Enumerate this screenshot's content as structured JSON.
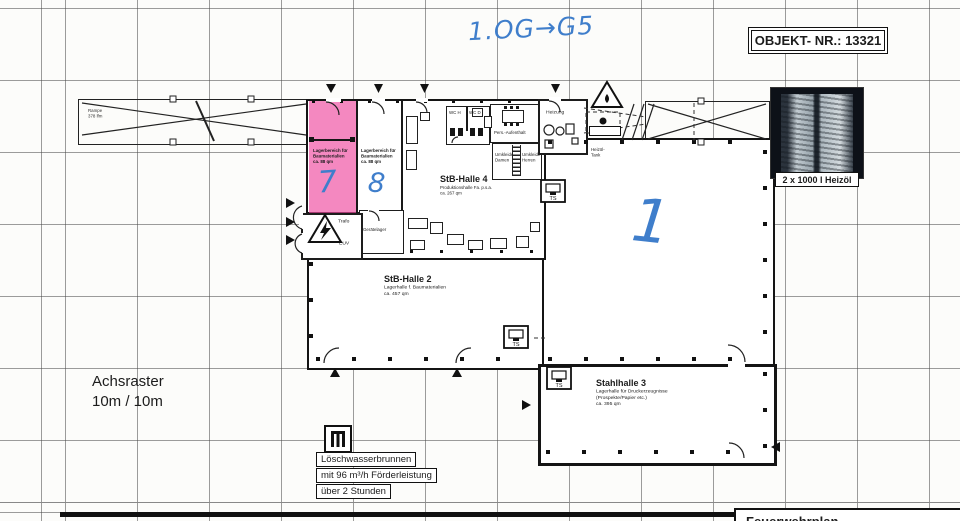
{
  "header": {
    "object_nr": "OBJEKT- NR.: 13321",
    "handwritten_note": "1.OG→G5"
  },
  "photo": {
    "caption": "2 x 1000 l Heizöl"
  },
  "axis": {
    "text": "Achsraster\n10m / 10m"
  },
  "halls": {
    "halle4": {
      "name": "StB-Halle 4",
      "details": "Produktionshalle Fa. p.s.a.\nca. 267 qm"
    },
    "halle2": {
      "name": "StB-Halle 2",
      "details": "Lagerhalle f. Baumaterialien\nca. 457 qm"
    },
    "halle3": {
      "name": "Stahlhalle 3",
      "details": "Lagerhalle für Druckerzeugnisse\n(Prospekte/Papier etc.)\nca. 395 qm"
    },
    "halle1": {
      "handwritten_number": "1"
    }
  },
  "storage": {
    "area7": {
      "text": "Lagerbereich für\nBaumaterialien\nca. 88 qm",
      "handwritten_number": "7"
    },
    "area8": {
      "text": "Lagerbereich für\nBaumaterialien\nca. 88 qm",
      "handwritten_number": "8"
    }
  },
  "rooms": {
    "trafo": "Trafo",
    "euv": "EUV",
    "geraetelager": "Gerätelager",
    "heizung": "Heizung",
    "heizoel_tank": "Heizöl-Tank",
    "wc_h": "WC H",
    "wc_d": "WC D",
    "aufenthalt": "Pers.-Aufenthalt",
    "umkleide_damen": "Umkleide\nDamen",
    "umkleide_herren": "Umkleide\nHerren",
    "rampe": "Rampe\n378 lfm"
  },
  "fire_protection": {
    "well_line1": "Löschwasserbrunnen",
    "well_line2": "mit 96 m³/h Förderleistung",
    "well_line3": "über 2 Stunden",
    "ts_label": "TS"
  },
  "title_block": {
    "partial_text": "Feuerwehrplan"
  },
  "colors": {
    "highlight_pink": "#ee4aa0",
    "handwriting_blue": "#3f7ecb",
    "ink": "#1c1c1c",
    "grid": "#4b4b4b",
    "paper": "#fcfcfa"
  }
}
